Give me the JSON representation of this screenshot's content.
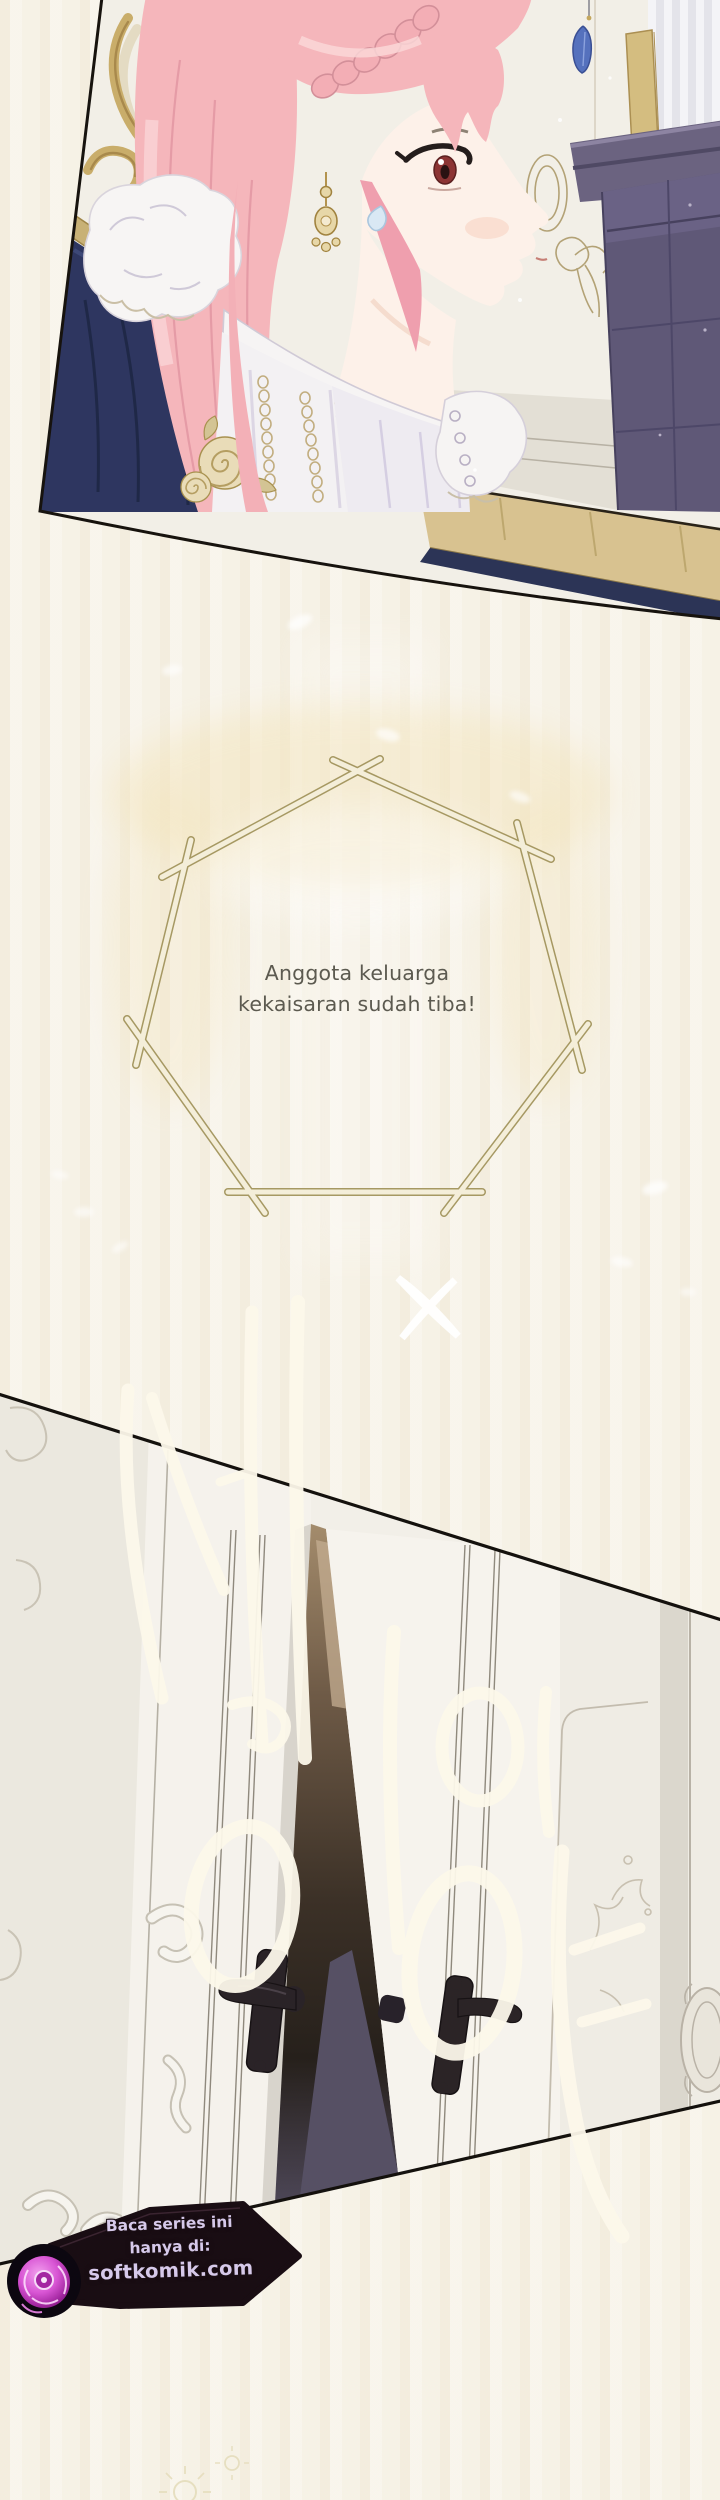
{
  "dialogue": {
    "line1": "Anggota keluarga",
    "line2": "kekaisaran sudah tiba!"
  },
  "sfx": {
    "text": "세이이야"
  },
  "watermark": {
    "line1": "Baca series ini",
    "line2": "hanya di:",
    "line3": "softkomik.com",
    "logo_icon": "rose-icon"
  },
  "colors": {
    "page_background": "#f7f3e8",
    "panel_outline": "#17130e",
    "hair_pink": "#f5b6bb",
    "hair_shadow": "#e59ba6",
    "eye_red": "#8c3434",
    "skin": "#fdf1e9",
    "couch_navy": "#2e3660",
    "cabinet_purple": "#5f5877",
    "gold_trim": "#c9b176",
    "stick_frame_fill": "#f4eed9",
    "stick_frame_outline": "#a2945c",
    "dialogue_text": "#5c5a50",
    "door_white": "#f6f3ed",
    "door_gap_dark": "#2c241d",
    "sfx_white": "#fcf8ea",
    "watermark_badge": "#190d13",
    "watermark_text": "#d6c9ea",
    "rose_magenta": "#c23fc0"
  }
}
